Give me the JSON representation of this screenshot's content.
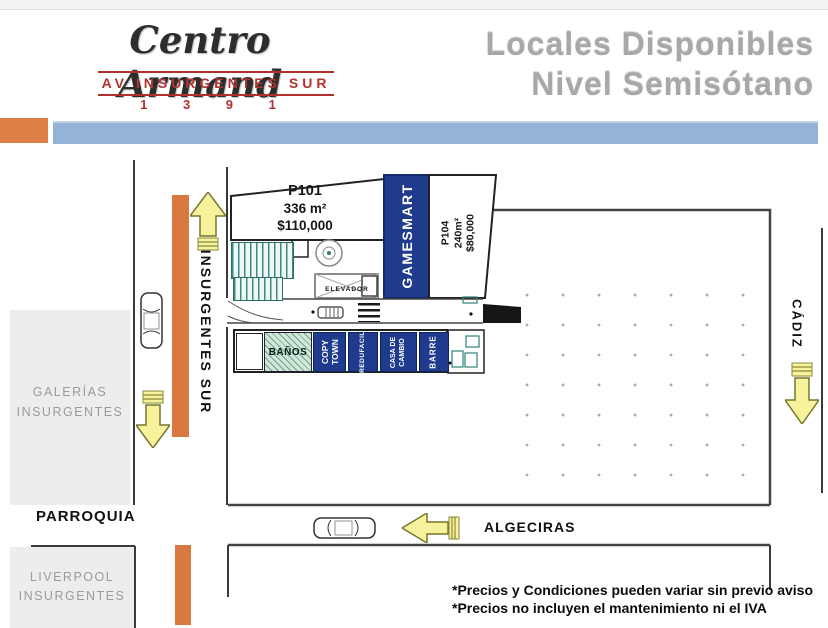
{
  "header": {
    "logo_name": "Centro Armand",
    "logo_address": "AV INSURGENTES SUR",
    "logo_number": "1 3 9 1",
    "title_line1": "Locales Disponibles",
    "title_line2": "Nivel Semisótano"
  },
  "plan": {
    "p101": {
      "id": "P101",
      "area": "336 m²",
      "price": "$110,000"
    },
    "p104": {
      "id": "P104",
      "area": "240m²",
      "price": "$80,000"
    },
    "gamesmart": "GAMESMART",
    "elevator": "ELEVADOR",
    "shops": {
      "banos": "BAÑOS",
      "copytown": "COPY\nTOWN",
      "redufacil": "REDUFACIL",
      "casadecambio": "CASA DE\nCAMBIO",
      "barre": "BARRE"
    }
  },
  "streets": {
    "insurgentes": "INSURGENTES SUR",
    "cadiz": "CÁDIZ",
    "algeciras": "ALGECIRAS"
  },
  "landmarks": {
    "galerias": "GALERÍAS\nINSURGENTES",
    "parroquia": "PARROQUIA",
    "liverpool": "LIVERPOOL\nINSURGENTES"
  },
  "footnotes": {
    "line1": "*Precios y Condiciones pueden variar sin previo aviso",
    "line2": "*Precios no incluyen el mantenimiento ni el IVA"
  },
  "colors": {
    "accent_orange": "#dd8047",
    "accent_blue": "#95b3d7",
    "unit_blue": "#1e3b8d",
    "arrow_yellow": "#f7f29c",
    "banos_green": "#cfe8d8",
    "brand_red": "#b23230"
  }
}
